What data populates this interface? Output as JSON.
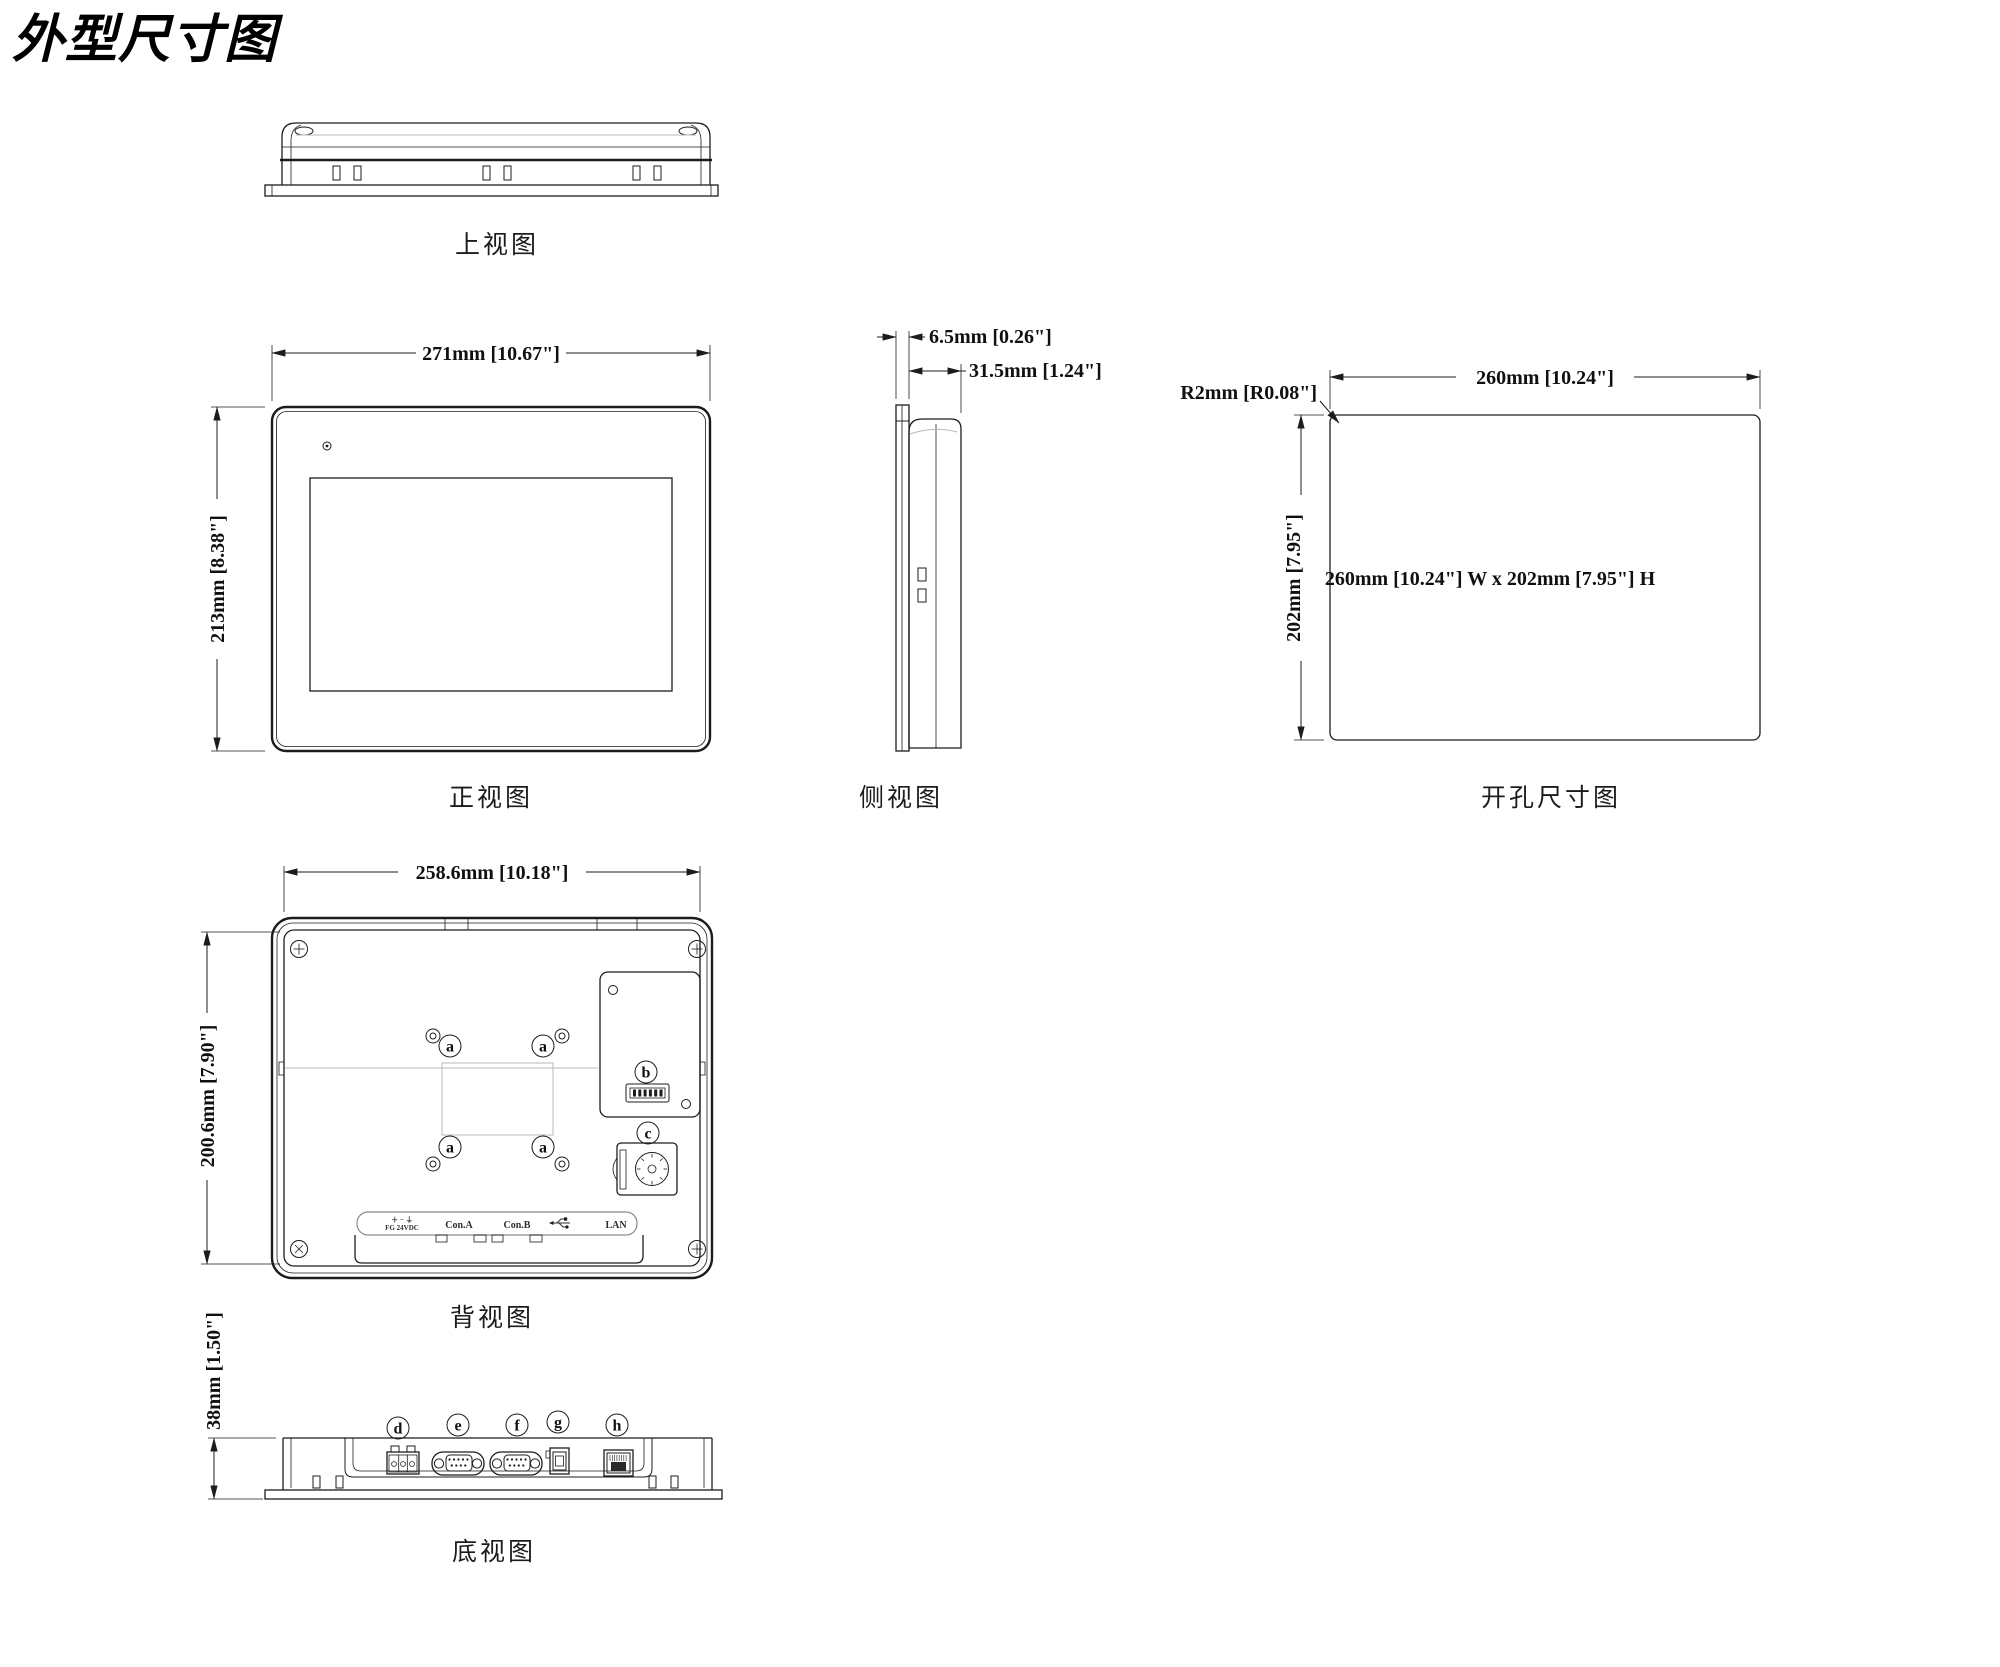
{
  "title": "外型尺寸图",
  "views": {
    "top": {
      "label": "上视图"
    },
    "front": {
      "label": "正视图",
      "dim_width": "271mm [10.67\"]",
      "dim_height": "213mm [8.38\"]"
    },
    "side": {
      "label": "侧视图",
      "dim_bezel_depth": "6.5mm [0.26\"]",
      "dim_body_depth": "31.5mm [1.24\"]"
    },
    "cutout": {
      "label": "开孔尺寸图",
      "dim_width": "260mm [10.24\"]",
      "dim_height": "202mm [7.95\"]",
      "corner_radius": "R2mm [R0.08\"]",
      "center_note": "260mm [10.24\"] W x 202mm [7.95\"] H"
    },
    "back": {
      "label": "背视图",
      "dim_width": "258.6mm [10.18\"]",
      "dim_height": "200.6mm [7.90\"]",
      "callout_a": "a",
      "callout_b": "b",
      "callout_c": "c",
      "port_labels": {
        "power_symbols": "＋ − ⏚",
        "power_text": "FG 24VDC",
        "com_a": "Con.A",
        "com_b": "Con.B",
        "lan": "LAN"
      }
    },
    "bottom": {
      "label": "底视图",
      "dim_depth": "38mm [1.50\"]",
      "callout_d": "d",
      "callout_e": "e",
      "callout_f": "f",
      "callout_g": "g",
      "callout_h": "h"
    }
  }
}
